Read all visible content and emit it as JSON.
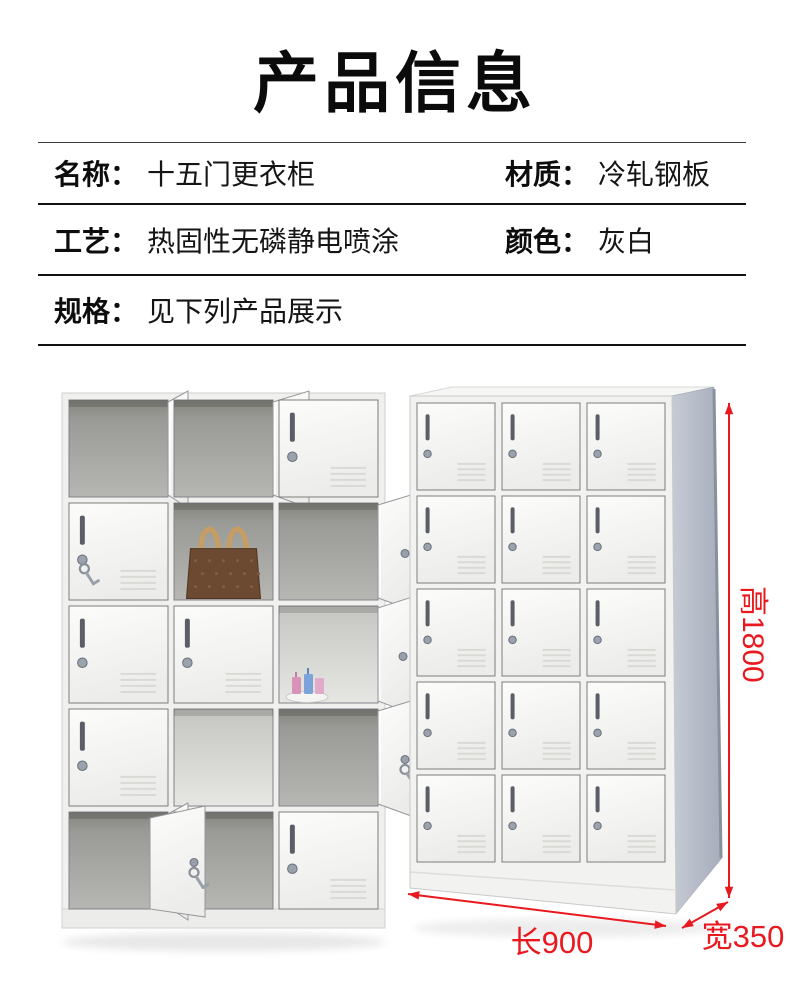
{
  "title": "产品信息",
  "specs": {
    "name": {
      "label": "名称：",
      "value": "十五门更衣柜"
    },
    "material": {
      "label": "材质：",
      "value": "冷轧钢板"
    },
    "process": {
      "label": "工艺：",
      "value": "热固性无磷静电喷涂"
    },
    "color": {
      "label": "颜色：",
      "value": "灰白"
    },
    "size": {
      "label": "规格：",
      "value": "见下列产品展示"
    }
  },
  "dimensions": {
    "height_label": "高1800",
    "length_label": "长900",
    "width_label": "宽350",
    "color": "#e8191f"
  },
  "lockers": {
    "left_photo": {
      "rows": 5,
      "cols": 3,
      "cells": [
        [
          "open",
          "door",
          "closed"
        ],
        [
          "keys",
          "bag",
          "door"
        ],
        [
          "closed",
          "closed",
          "cups"
        ],
        [
          "closed",
          "openlight",
          "doorkeys"
        ],
        [
          "open",
          "ajar",
          "closed"
        ]
      ]
    },
    "right_photo": {
      "rows": 5,
      "cols": 3,
      "all": "closed"
    },
    "palette": {
      "door_light": "#fcfcfa",
      "door_dark": "#ededeb",
      "frame": "#f0f0ee",
      "interior_dark": "#8c8c88",
      "interior_light": "#cdcdc9",
      "side_panel": "#b4bac6",
      "bag_body": "#6b4a31",
      "bag_handle": "#c79d63"
    }
  }
}
